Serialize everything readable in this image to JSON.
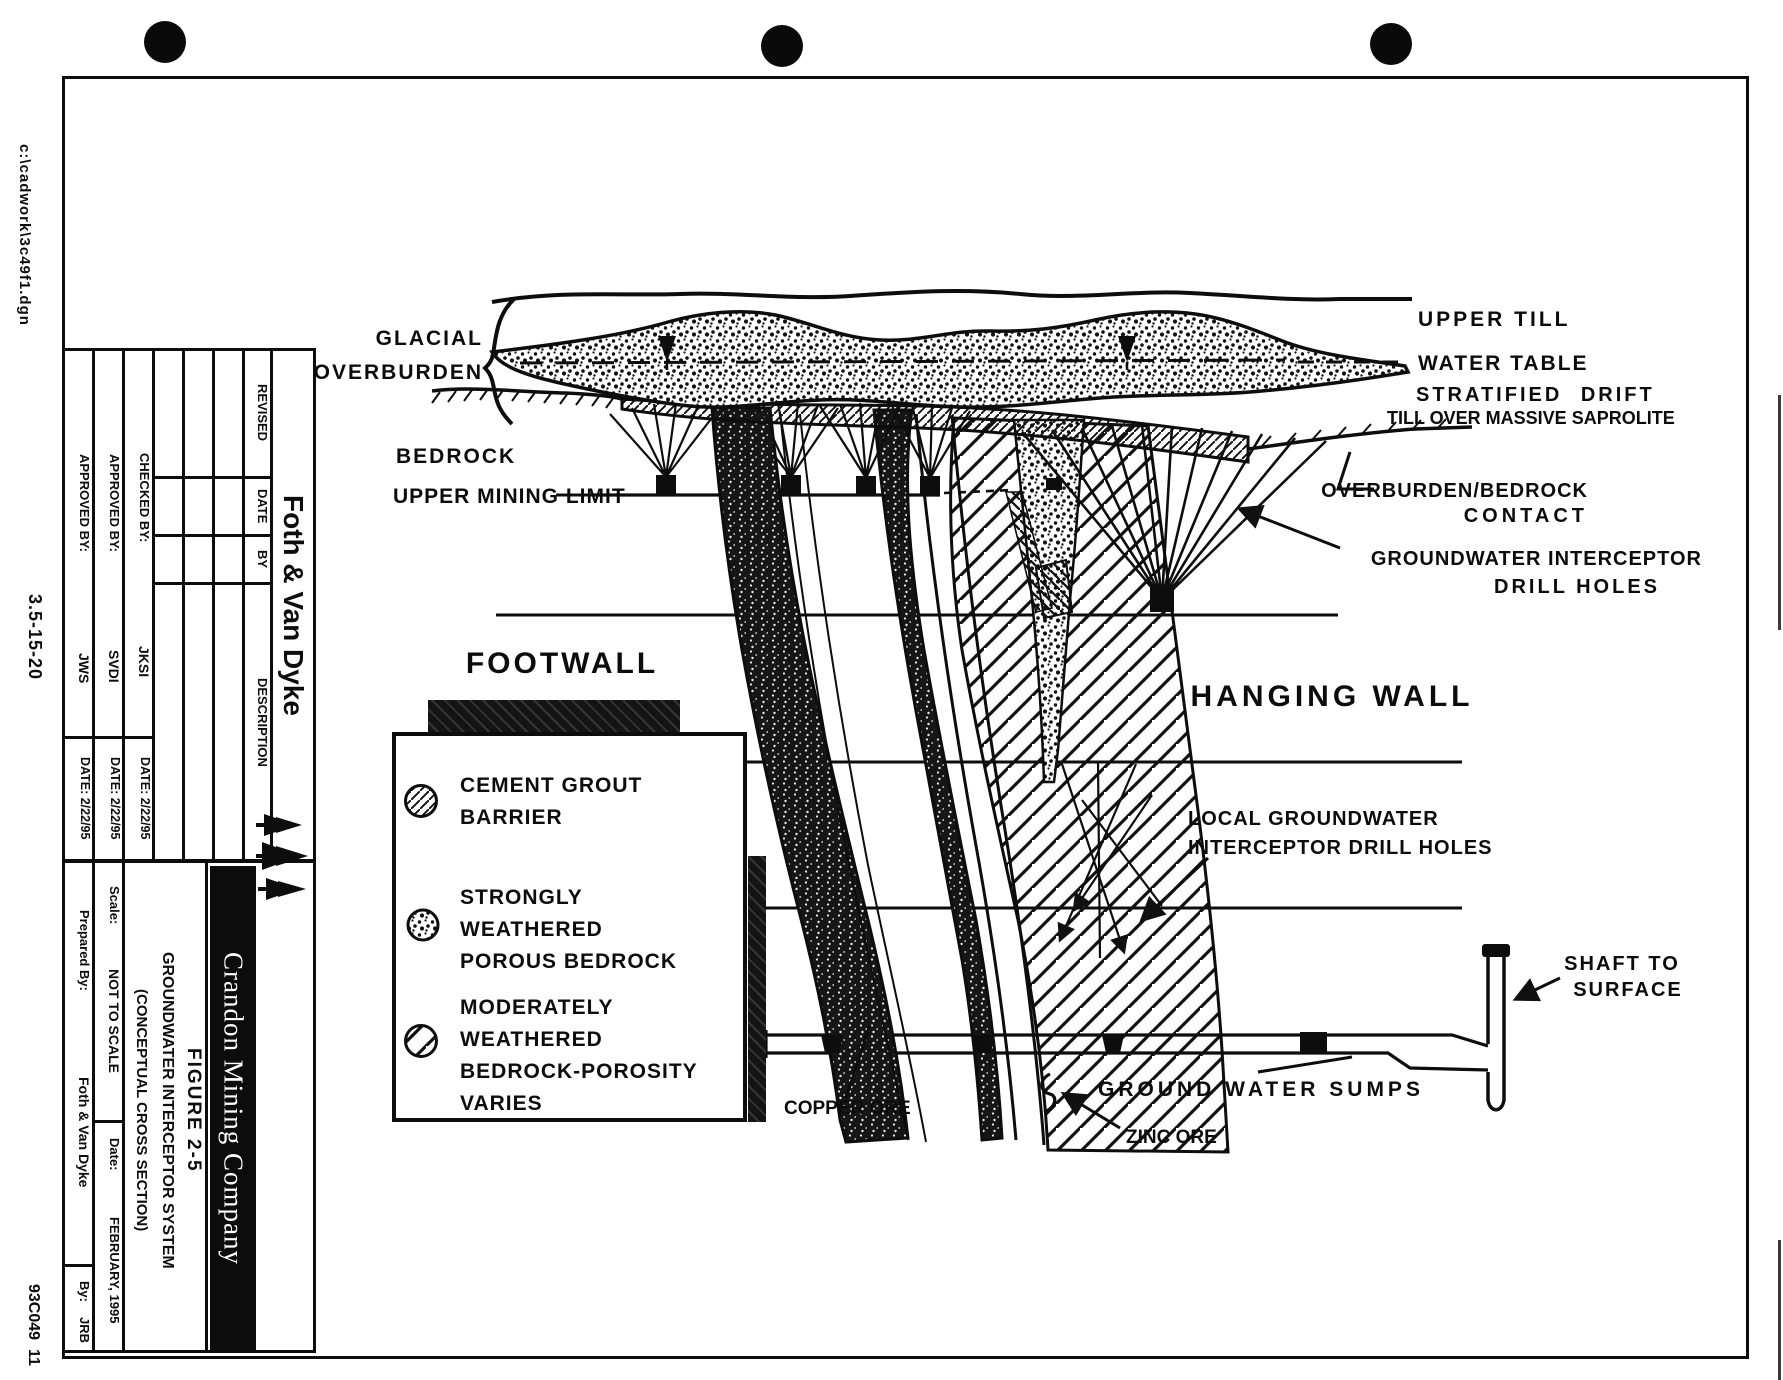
{
  "margin": {
    "file_path": "c:\\cadwork\\3c49f1.dgn",
    "doc_number": "3.5-15-20",
    "sheet_code": "93C049  11"
  },
  "title_block": {
    "company_name": "Foth & Van Dyke",
    "revision_table": {
      "revised": "REVISED",
      "date": "DATE",
      "by": "BY",
      "description": "DESCRIPTION"
    },
    "checked_by_label": "CHECKED BY:",
    "checked_by": "JKSI",
    "checked_date": "DATE: 2/22/95",
    "approved1_label": "APPROVED BY:",
    "approved1": "SVDI",
    "approved1_date": "DATE: 2/22/95",
    "approved2_label": "APPROVED BY:",
    "approved2": "JWS",
    "approved2_date": "DATE: 2/22/95",
    "prepared_label": "Prepared By:",
    "prepared_value": "Foth & Van Dyke",
    "by_label": "By:",
    "by_value": "JRB",
    "scale_label": "Scale:",
    "scale_value": "NOT TO SCALE",
    "date_label": "Date:",
    "date_value": "FEBRUARY, 1995",
    "figure_number": "FIGURE 2-5",
    "figure_title": "GROUNDWATER INTERCEPTOR SYSTEM",
    "figure_subtitle": "(CONCEPTUAL CROSS SECTION)",
    "client": "Crandon Mining Company"
  },
  "legend": {
    "items": [
      {
        "icon": "fine-diagonal-hatch-circle",
        "lines": [
          "CEMENT GROUT",
          "BARRIER"
        ]
      },
      {
        "icon": "stipple-circle",
        "lines": [
          "STRONGLY",
          "WEATHERED",
          "POROUS BEDROCK"
        ]
      },
      {
        "icon": "wide-diagonal-stripe-circle",
        "lines": [
          "MODERATELY",
          "WEATHERED",
          "BEDROCK-POROSITY",
          "VARIES"
        ]
      }
    ]
  },
  "diagram": {
    "labels": {
      "glacial": "GLACIAL",
      "overburden": "OVERBURDEN",
      "bedrock": "BEDROCK",
      "upper_mining_limit": "UPPER MINING LIMIT",
      "upper_till": "UPPER TILL",
      "water_table": "WATER TABLE",
      "stratified_drift": "STRATIFIED DRIFT",
      "till_saprolite": "TILL OVER MASSIVE SAPROLITE",
      "ob_contact_1": "OVERBURDEN/BEDROCK",
      "ob_contact_2": "CONTACT",
      "gw_interceptor_1": "GROUNDWATER INTERCEPTOR",
      "gw_interceptor_2": "DRILL HOLES",
      "footwall": "FOOTWALL",
      "hanging_wall": "HANGING WALL",
      "local_gw_1": "LOCAL GROUNDWATER",
      "local_gw_2": "INTERCEPTOR DRILL HOLES",
      "shaft_1": "SHAFT TO",
      "shaft_2": "SURFACE",
      "sumps": "GROUND WATER SUMPS",
      "copper_ore": "COPPER ORE",
      "zinc_ore": "ZINC ORE"
    }
  }
}
